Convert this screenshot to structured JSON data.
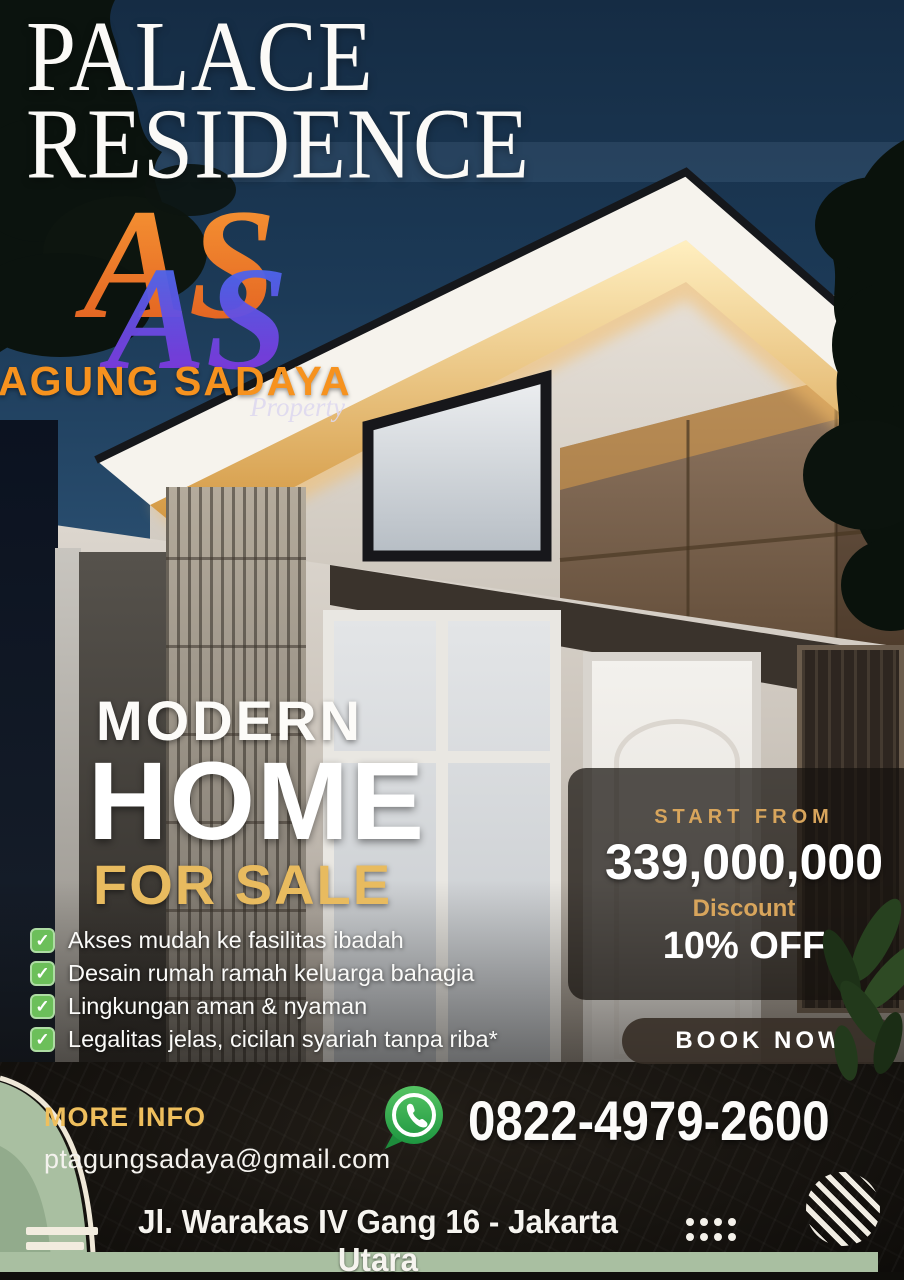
{
  "poster": {
    "title_line1": "PALACE",
    "title_line2": "RESIDENCE",
    "logo": {
      "monogram": "AS",
      "company": "AGUNG SADAYA",
      "division": "Property"
    },
    "headline": {
      "line1": "MODERN",
      "line2": "HOME",
      "line3": "FOR SALE"
    },
    "features": [
      {
        "label": "Akses mudah ke fasilitas ibadah"
      },
      {
        "label": "Desain rumah ramah keluarga bahagia"
      },
      {
        "label": "Lingkungan aman & nyaman"
      },
      {
        "label": "Legalitas jelas, cicilan syariah tanpa riba*"
      }
    ],
    "pricing": {
      "start_from_label": "START FROM",
      "price": "339,000,000",
      "discount_label": "Discount",
      "discount_value": "10% OFF"
    },
    "cta": {
      "book_now_label": "BOOK NOW"
    },
    "contact": {
      "more_info_label": "MORE INFO",
      "email": "ptagungsadaya@gmail.com",
      "phone": "0822-4979-2600"
    },
    "address": "Jl. Warakas IV Gang 16 - Jakarta Utara",
    "icons": {
      "check": "✓",
      "whatsapp": "whatsapp-icon",
      "striped_circle": "striped-circle-ornament",
      "dots": "dots-grid-ornament"
    },
    "colors": {
      "sky_navy": "#1C3A57",
      "accent_gold": "#E8BB5F",
      "accent_orange": "#F6921E",
      "check_green": "#6CBF5A",
      "whatsapp_green": "#2EA148",
      "sage_green": "#A9BFA1",
      "panel_overlay": "rgba(22,18,14,0.72)"
    }
  }
}
